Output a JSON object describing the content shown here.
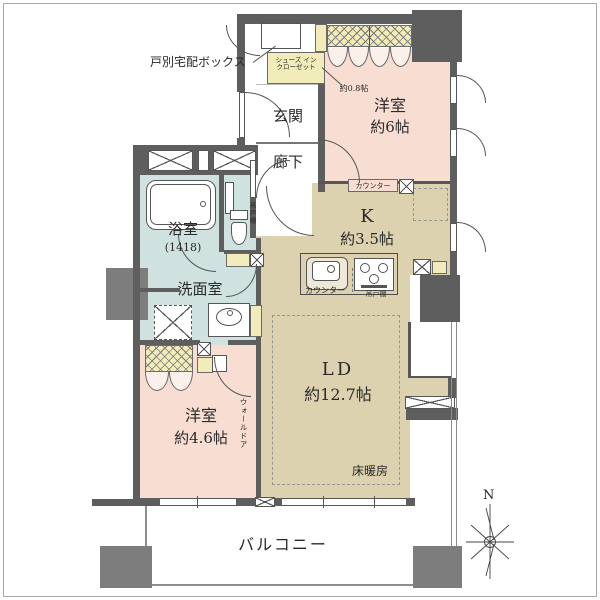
{
  "colors": {
    "wall": "#5e5e5e",
    "pillar": "#7d7d7d",
    "pink": "#f8ddd3",
    "tan": "#ddd2af",
    "blue": "#cfe2df",
    "yellow": "#f1ecb9",
    "text": "#2a2a2a"
  },
  "areas": {
    "entry": {
      "delivery_box_label": "戸別宅配ボックス",
      "shoe_closet_line1": "シューズ イン",
      "shoe_closet_line2": "クローゼット",
      "shoe_closet_size": "約0.8帖",
      "genkan": "玄関",
      "corridor": "廊下"
    },
    "bedroom_main": {
      "name": "洋室",
      "size": "約6帖"
    },
    "kitchen": {
      "name": "K",
      "size": "約3.5帖",
      "counter_upper": "カウンター",
      "counter_lower": "カウンター",
      "hanging_cupboard": "吊戸棚"
    },
    "bathroom": {
      "name": "浴室",
      "size": "(1418)"
    },
    "toilet": {
      "hanging_cupboard": "吊戸棚"
    },
    "washroom": {
      "name": "洗面室"
    },
    "bedroom_second": {
      "name": "洋室",
      "size": "約4.6帖",
      "wall_door": "ウォールドア"
    },
    "living_dining": {
      "name": "LD",
      "size": "約12.7帖",
      "floor_heating": "床暖房"
    },
    "balcony": {
      "name": "バルコニー"
    },
    "compass": {
      "north": "N"
    }
  }
}
